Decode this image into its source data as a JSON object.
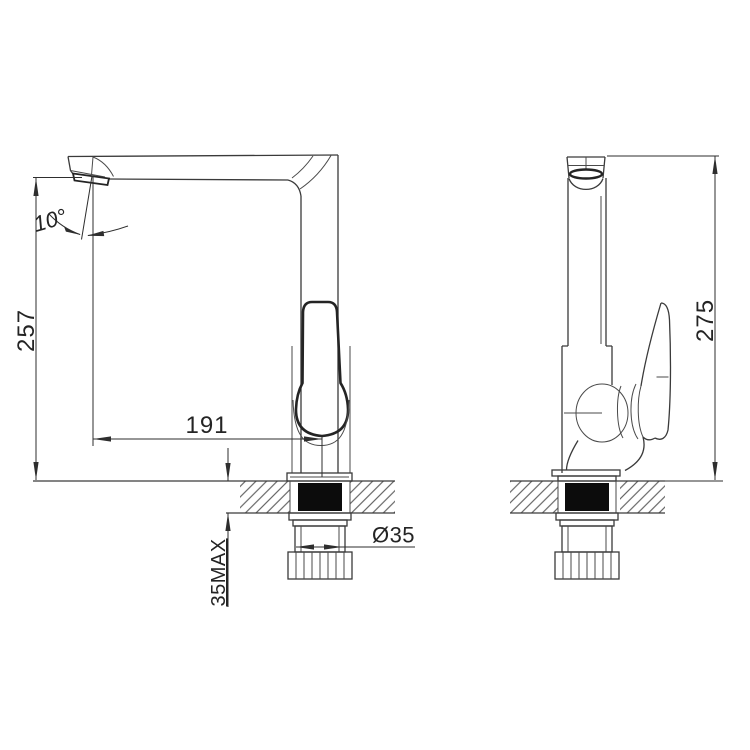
{
  "drawing": {
    "front_view": {
      "spout_height": "257",
      "spout_angle": "10°",
      "spout_reach": "191",
      "max_mounting_thickness": "35MAX",
      "mounting_hole_diameter": "Ø35"
    },
    "side_view": {
      "overall_height": "275"
    }
  }
}
